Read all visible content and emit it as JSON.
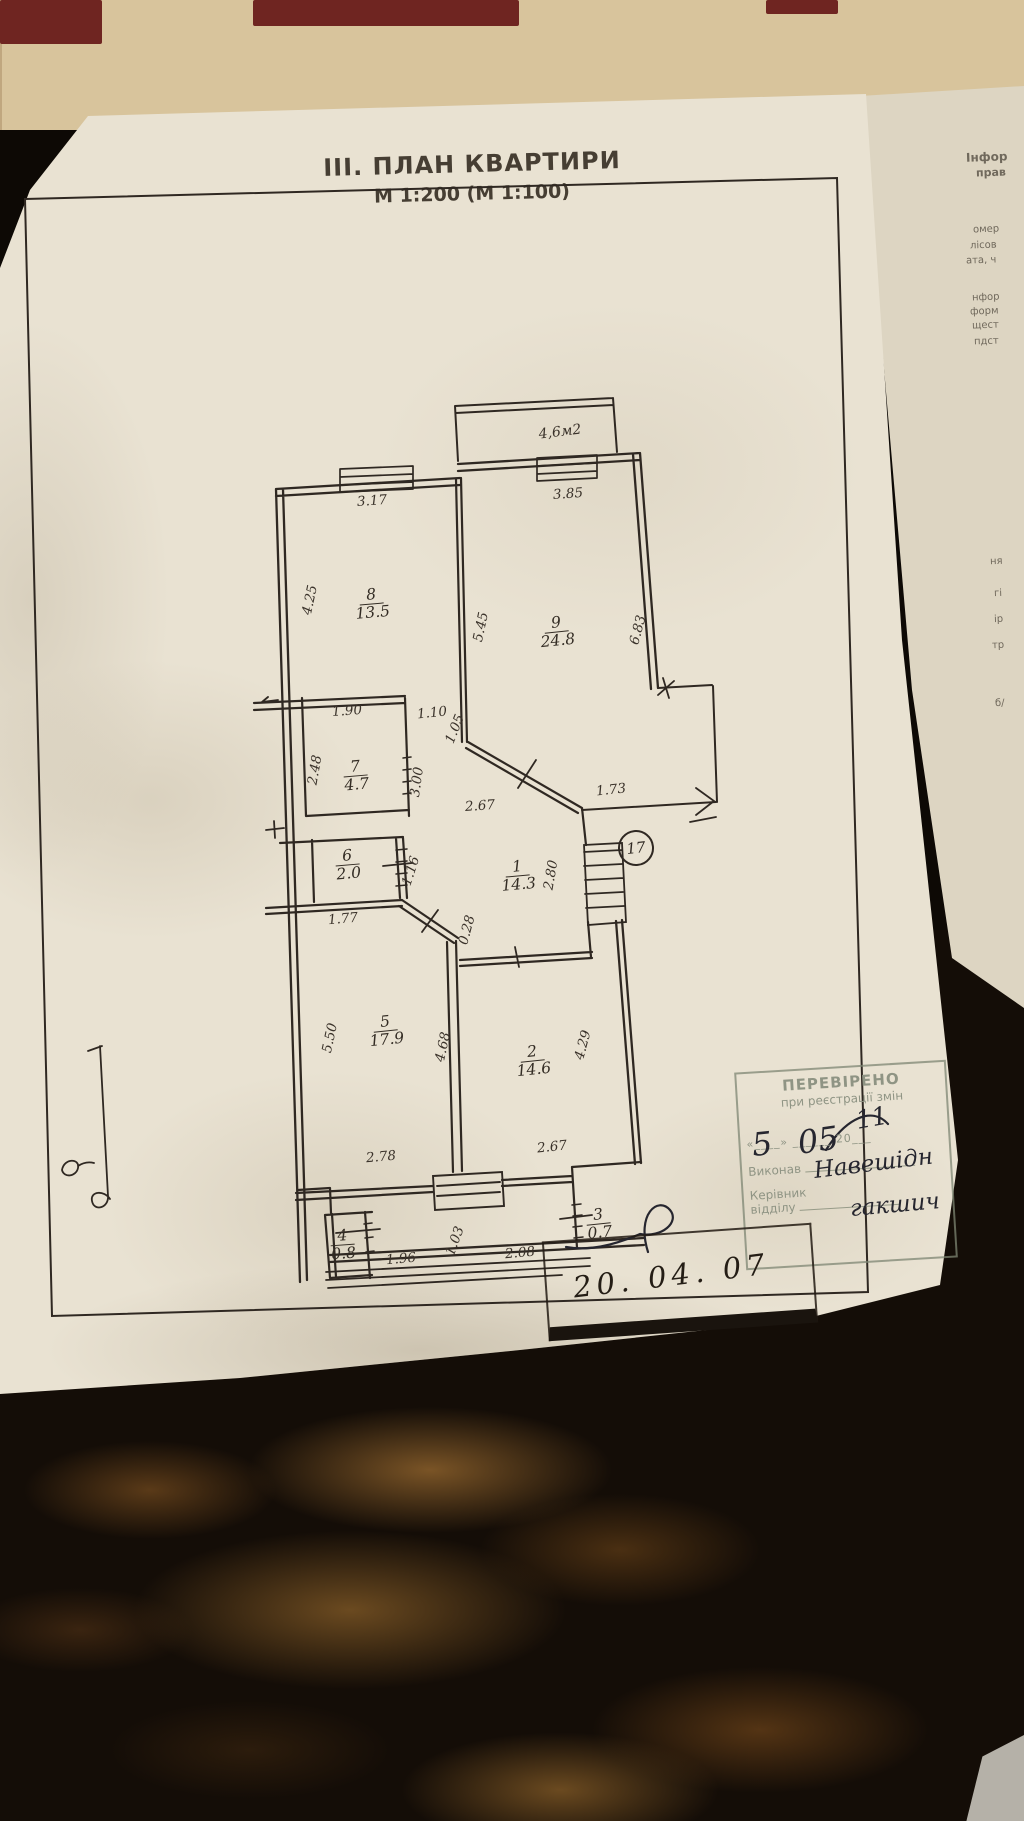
{
  "document": {
    "title": "ІІІ. ПЛАН КВАРТИРИ",
    "subtitle": "М 1:200 (М 1:100)"
  },
  "plan": {
    "balcony_label": "4,6м2",
    "apartment_number": "17",
    "rooms": [
      {
        "number": "1",
        "area": "14.3",
        "x": 518,
        "y": 876,
        "rot": -5
      },
      {
        "number": "2",
        "area": "14.6",
        "x": 533,
        "y": 1061,
        "rot": -6
      },
      {
        "number": "3",
        "area": "0.7",
        "x": 599,
        "y": 1224,
        "rot": -6
      },
      {
        "number": "4",
        "area": "0.8",
        "x": 343,
        "y": 1245,
        "rot": -4
      },
      {
        "number": "5",
        "area": "17.9",
        "x": 386,
        "y": 1031,
        "rot": -6
      },
      {
        "number": "6",
        "area": "2.0",
        "x": 348,
        "y": 865,
        "rot": -5
      },
      {
        "number": "7",
        "area": "4.7",
        "x": 356,
        "y": 776,
        "rot": -5
      },
      {
        "number": "8",
        "area": "13.5",
        "x": 372,
        "y": 604,
        "rot": -5
      },
      {
        "number": "9",
        "area": "24.8",
        "x": 557,
        "y": 632,
        "rot": -6
      }
    ],
    "dimensions": [
      {
        "value": "3.17",
        "x": 372,
        "y": 501,
        "rot": -4
      },
      {
        "value": "3.85",
        "x": 568,
        "y": 494,
        "rot": -4
      },
      {
        "value": "4.25",
        "x": 310,
        "y": 600,
        "rot": -78
      },
      {
        "value": "5.45",
        "x": 481,
        "y": 627,
        "rot": -78
      },
      {
        "value": "6.83",
        "x": 638,
        "y": 630,
        "rot": -75
      },
      {
        "value": "1.90",
        "x": 347,
        "y": 711,
        "rot": -4
      },
      {
        "value": "1.10",
        "x": 432,
        "y": 713,
        "rot": -6
      },
      {
        "value": "1.05",
        "x": 455,
        "y": 729,
        "rot": -68
      },
      {
        "value": "2.48",
        "x": 315,
        "y": 770,
        "rot": -80
      },
      {
        "value": "3.00",
        "x": 417,
        "y": 782,
        "rot": -82
      },
      {
        "value": "1.73",
        "x": 611,
        "y": 790,
        "rot": -6
      },
      {
        "value": "2.67",
        "x": 480,
        "y": 806,
        "rot": -4
      },
      {
        "value": "1.16",
        "x": 411,
        "y": 871,
        "rot": -72
      },
      {
        "value": "2.80",
        "x": 551,
        "y": 875,
        "rot": -80
      },
      {
        "value": "1.77",
        "x": 343,
        "y": 919,
        "rot": -5
      },
      {
        "value": "0.28",
        "x": 467,
        "y": 930,
        "rot": -75
      },
      {
        "value": "5.50",
        "x": 330,
        "y": 1038,
        "rot": -78
      },
      {
        "value": "4.68",
        "x": 443,
        "y": 1047,
        "rot": -78
      },
      {
        "value": "4.29",
        "x": 583,
        "y": 1045,
        "rot": -75
      },
      {
        "value": "2.78",
        "x": 381,
        "y": 1157,
        "rot": -5
      },
      {
        "value": "2.67",
        "x": 552,
        "y": 1147,
        "rot": -6
      },
      {
        "value": "1.96",
        "x": 401,
        "y": 1259,
        "rot": -5
      },
      {
        "value": "1.03",
        "x": 455,
        "y": 1241,
        "rot": -70
      },
      {
        "value": "2.08",
        "x": 520,
        "y": 1253,
        "rot": -5
      }
    ]
  },
  "stamps": {
    "verification": {
      "title": "ПЕРЕВІРЕНО",
      "subtitle": "при реєстрації змін",
      "date_row": "«____»  ______  20___",
      "executor_label": "Виконав",
      "head_label_1": "Керівник",
      "head_label_2": "відділу",
      "handwriting": [
        {
          "text": "5",
          "x": 752,
          "y": 1126,
          "size": 32,
          "rot": -6
        },
        {
          "text": "05",
          "x": 798,
          "y": 1124,
          "size": 32,
          "rot": -8
        },
        {
          "text": "11",
          "x": 856,
          "y": 1106,
          "size": 25,
          "rot": -10
        },
        {
          "text": "Навешідн",
          "x": 814,
          "y": 1158,
          "size": 23,
          "rot": -7
        },
        {
          "text": "гакшич",
          "x": 850,
          "y": 1196,
          "size": 23,
          "rot": -5
        }
      ]
    },
    "date_stamp": {
      "date": "20. 04. 07"
    }
  },
  "background_sheet": {
    "fragments": [
      {
        "text": "Інфор",
        "x": 966,
        "y": 150,
        "size": 12,
        "bold": true
      },
      {
        "text": "прав",
        "x": 976,
        "y": 166,
        "size": 11,
        "bold": true
      },
      {
        "text": "омер",
        "x": 973,
        "y": 224,
        "size": 10,
        "bold": false
      },
      {
        "text": "лісов",
        "x": 970,
        "y": 240,
        "size": 10,
        "bold": false
      },
      {
        "text": "ата, ч",
        "x": 966,
        "y": 255,
        "size": 10,
        "bold": false
      },
      {
        "text": "нфор",
        "x": 972,
        "y": 292,
        "size": 10,
        "bold": false
      },
      {
        "text": "форм",
        "x": 970,
        "y": 306,
        "size": 10,
        "bold": false
      },
      {
        "text": "щест",
        "x": 972,
        "y": 320,
        "size": 10,
        "bold": false
      },
      {
        "text": "пдст",
        "x": 974,
        "y": 336,
        "size": 10,
        "bold": false
      },
      {
        "text": "ня",
        "x": 990,
        "y": 556,
        "size": 10,
        "bold": false
      },
      {
        "text": "гі",
        "x": 994,
        "y": 588,
        "size": 10,
        "bold": false
      },
      {
        "text": "ір",
        "x": 994,
        "y": 614,
        "size": 10,
        "bold": false
      },
      {
        "text": "тр",
        "x": 992,
        "y": 640,
        "size": 10,
        "bold": false
      },
      {
        "text": "б/",
        "x": 995,
        "y": 698,
        "size": 10,
        "bold": false
      }
    ]
  },
  "colors": {
    "plan_ink": "#2f2822",
    "pen_ink": "#26262f",
    "stamp_ink": "#8f9484",
    "date_stamp_ink": "#1d1710",
    "paper": "#e9e2d2",
    "under_paper": "#ddd5c2",
    "tile_tan": "#c3a77c",
    "tile_maroon": "#6f2521",
    "marble_dark": "#140d07"
  }
}
